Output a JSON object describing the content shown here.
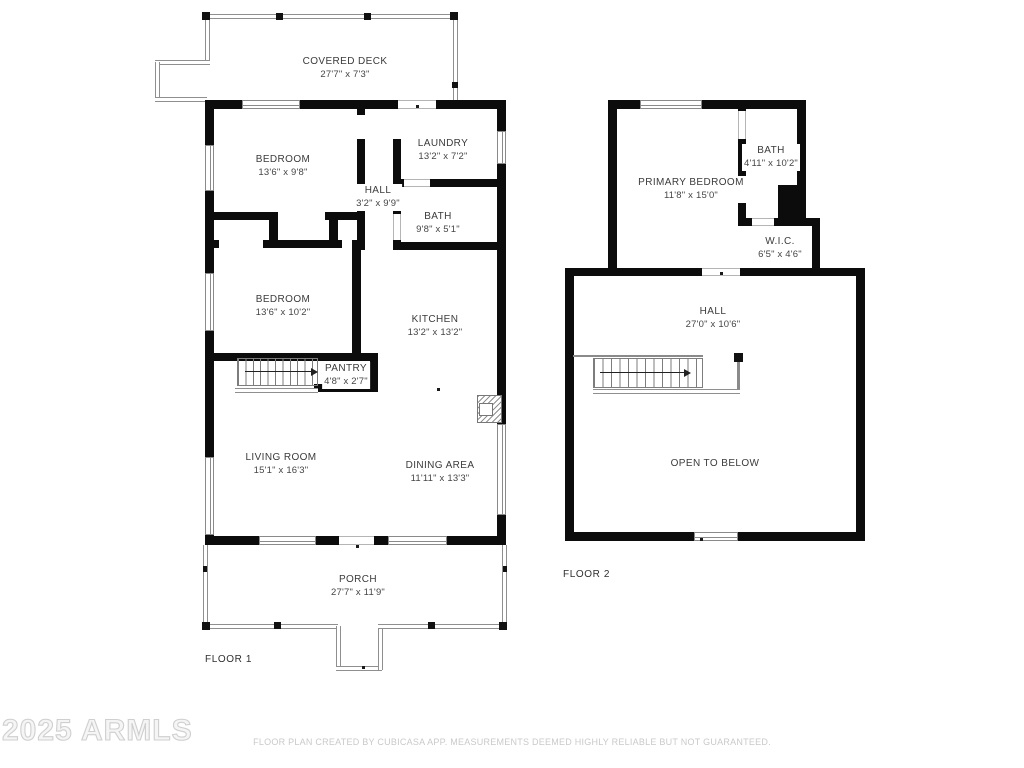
{
  "watermark": "2025 ARMLS",
  "footer": "FLOOR PLAN CREATED BY CUBICASA APP. MEASUREMENTS DEEMED HIGHLY RELIABLE BUT NOT GUARANTEED.",
  "floor1": {
    "label": "FLOOR 1",
    "rooms": {
      "covered_deck": {
        "name": "COVERED DECK",
        "dims": "27'7\" x 7'3\""
      },
      "bedroom1": {
        "name": "BEDROOM",
        "dims": "13'6\" x 9'8\""
      },
      "laundry": {
        "name": "LAUNDRY",
        "dims": "13'2\" x 7'2\""
      },
      "hall": {
        "name": "HALL",
        "dims": "3'2\" x 9'9\""
      },
      "bath": {
        "name": "BATH",
        "dims": "9'8\" x 5'1\""
      },
      "bedroom2": {
        "name": "BEDROOM",
        "dims": "13'6\" x 10'2\""
      },
      "kitchen": {
        "name": "KITCHEN",
        "dims": "13'2\" x 13'2\""
      },
      "pantry": {
        "name": "PANTRY",
        "dims": "4'8\" x 2'7\""
      },
      "living_room": {
        "name": "LIVING ROOM",
        "dims": "15'1\" x 16'3\""
      },
      "dining_area": {
        "name": "DINING AREA",
        "dims": "11'11\" x 13'3\""
      },
      "porch": {
        "name": "PORCH",
        "dims": "27'7\" x 11'9\""
      }
    }
  },
  "floor2": {
    "label": "FLOOR 2",
    "rooms": {
      "primary_bedroom": {
        "name": "PRIMARY BEDROOM",
        "dims": "11'8\" x 15'0\""
      },
      "bath": {
        "name": "BATH",
        "dims": "4'11\" x 10'2\""
      },
      "wic": {
        "name": "W.I.C.",
        "dims": "6'5\" x 4'6\""
      },
      "hall": {
        "name": "HALL",
        "dims": "27'0\" x 10'6\""
      },
      "open_to_below": {
        "name": "OPEN TO BELOW",
        "dims": ""
      }
    }
  }
}
